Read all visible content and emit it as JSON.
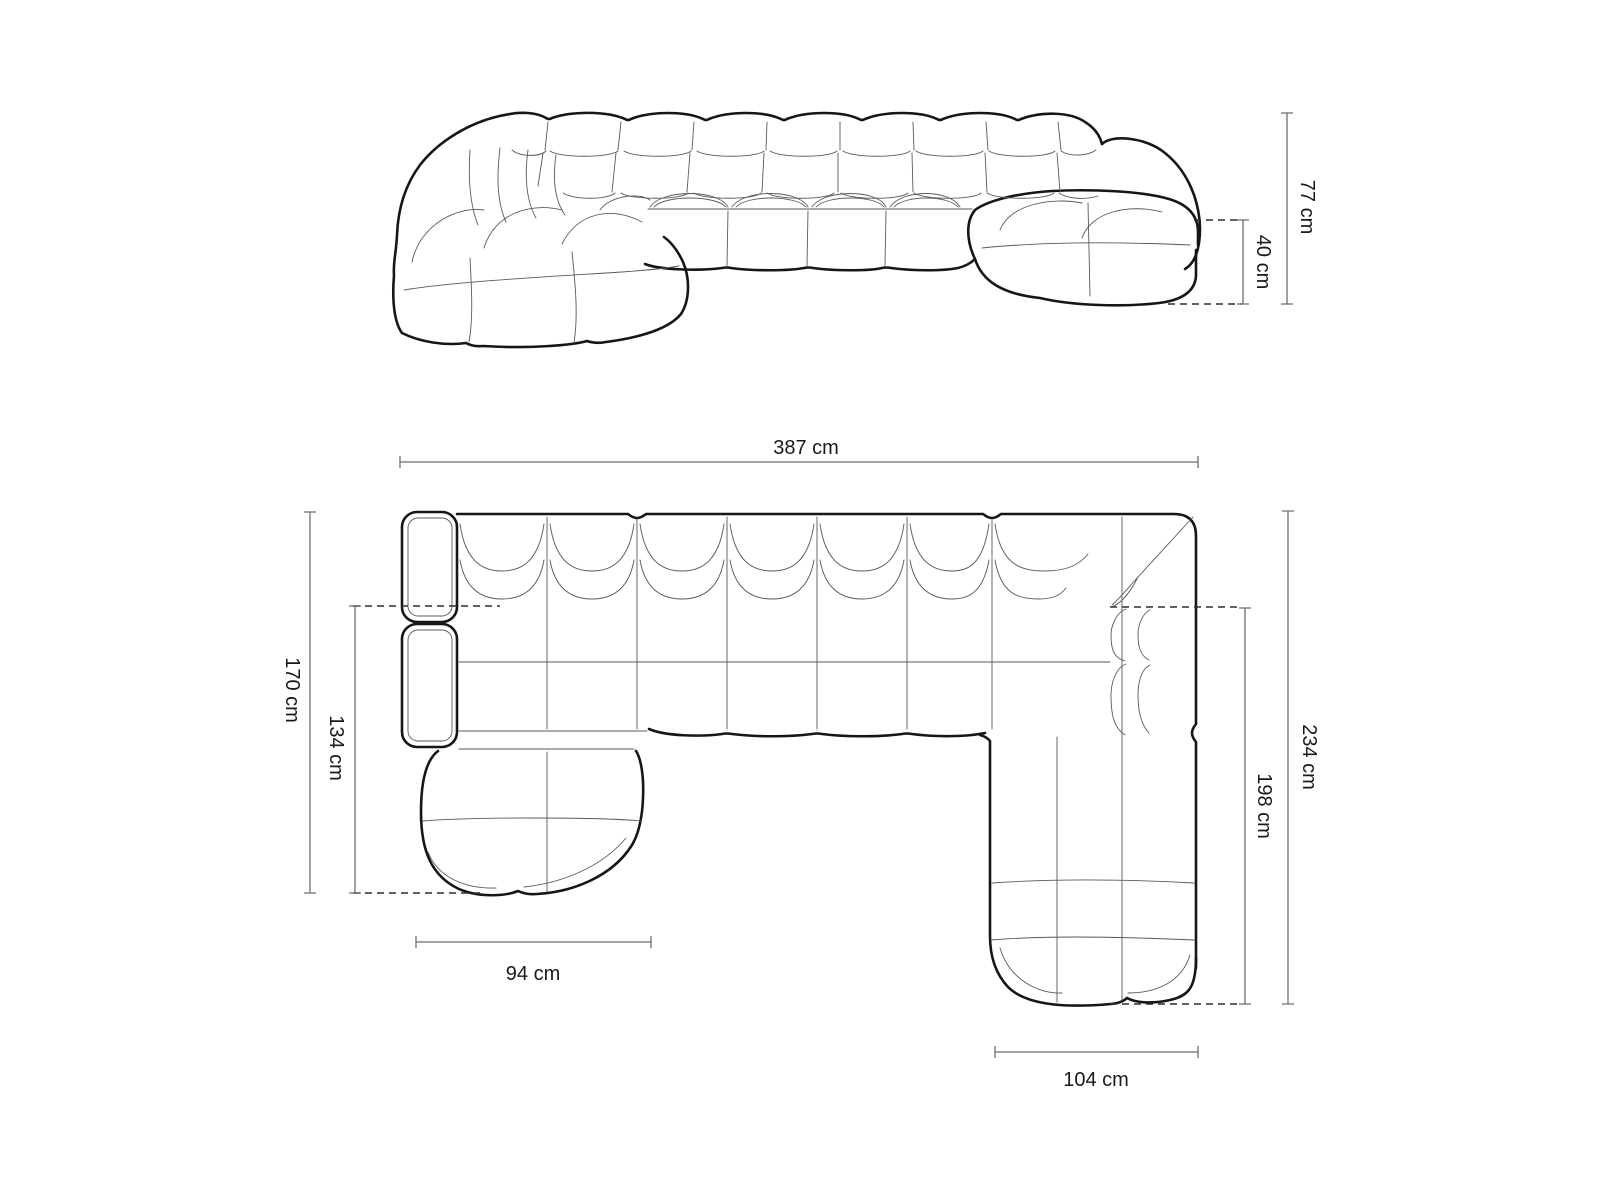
{
  "colors": {
    "background": "#ffffff",
    "outline_bold": "#161616",
    "outline_thin": "#5a5a5a",
    "dimension_line": "#6e6e6e",
    "dashed_line": "#2e2e2e",
    "label_text": "#1a1a1a"
  },
  "front_view": {
    "dims": {
      "total_height": {
        "label": "77 cm"
      },
      "seat_height": {
        "label": "40 cm"
      }
    }
  },
  "top_view": {
    "dims": {
      "total_width": {
        "label": "387 cm"
      },
      "left_depth": {
        "label": "170 cm"
      },
      "left_chaise_depth": {
        "label": "134 cm"
      },
      "left_chaise_width": {
        "label": "94 cm"
      },
      "right_depth": {
        "label": "234 cm"
      },
      "right_chaise_depth": {
        "label": "198 cm"
      },
      "right_chaise_width": {
        "label": "104 cm"
      }
    }
  }
}
